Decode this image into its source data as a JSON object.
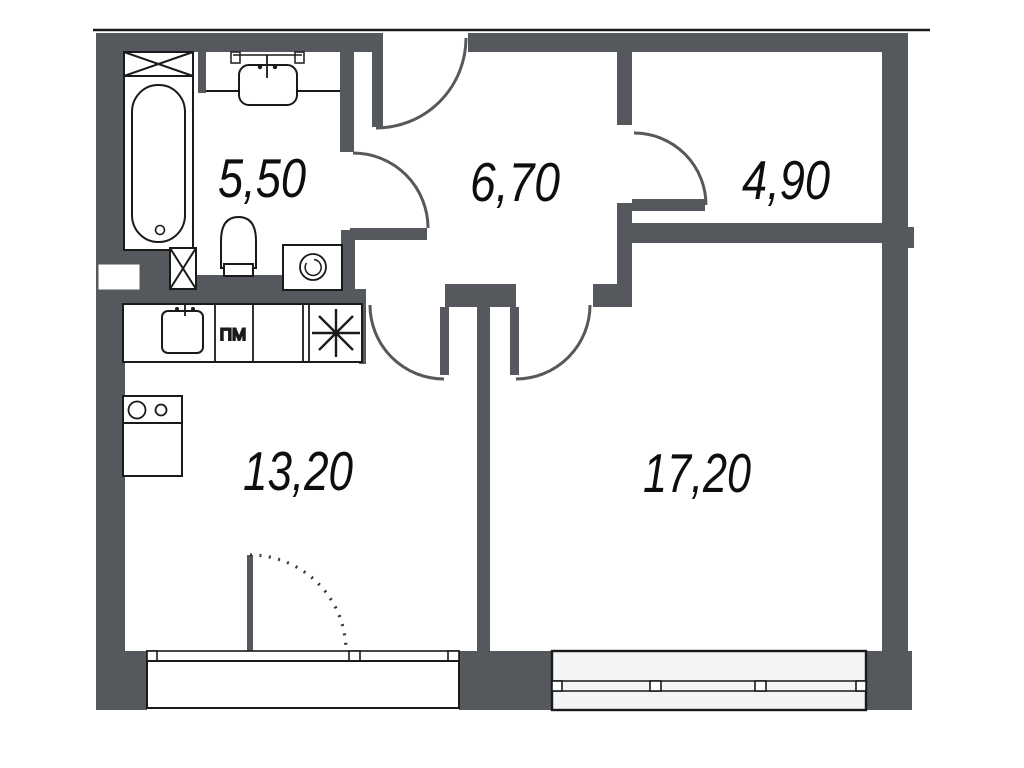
{
  "plan": {
    "type": "apartment-floor-plan",
    "colors": {
      "wall": "#55585c",
      "line": "#1a1a1a",
      "glass": "#f3f4f5",
      "background": "#ffffff",
      "label": "#0e0e0e"
    },
    "rooms": [
      {
        "id": "bathroom",
        "area": "5,50"
      },
      {
        "id": "hallway",
        "area": "6,70"
      },
      {
        "id": "wardrobe",
        "area": "4,90"
      },
      {
        "id": "kitchen",
        "area": "13,20"
      },
      {
        "id": "living-room",
        "area": "17,20"
      }
    ],
    "kitchen": {
      "dishwasher_label": "ПМ"
    },
    "fixtures": [
      "bathtub",
      "bathroom-sink",
      "toilet",
      "washing-machine",
      "ventilation-shaft-top",
      "ventilation-shaft-bottom",
      "kitchen-sink",
      "dishwasher",
      "burner-symbol",
      "cooktop",
      "kitchen-cabinet",
      "entry-door",
      "bathroom-door",
      "wardrobe-door",
      "kitchen-door",
      "living-room-door",
      "balcony-door-dotted",
      "kitchen-window",
      "living-room-window",
      "balcony"
    ]
  }
}
